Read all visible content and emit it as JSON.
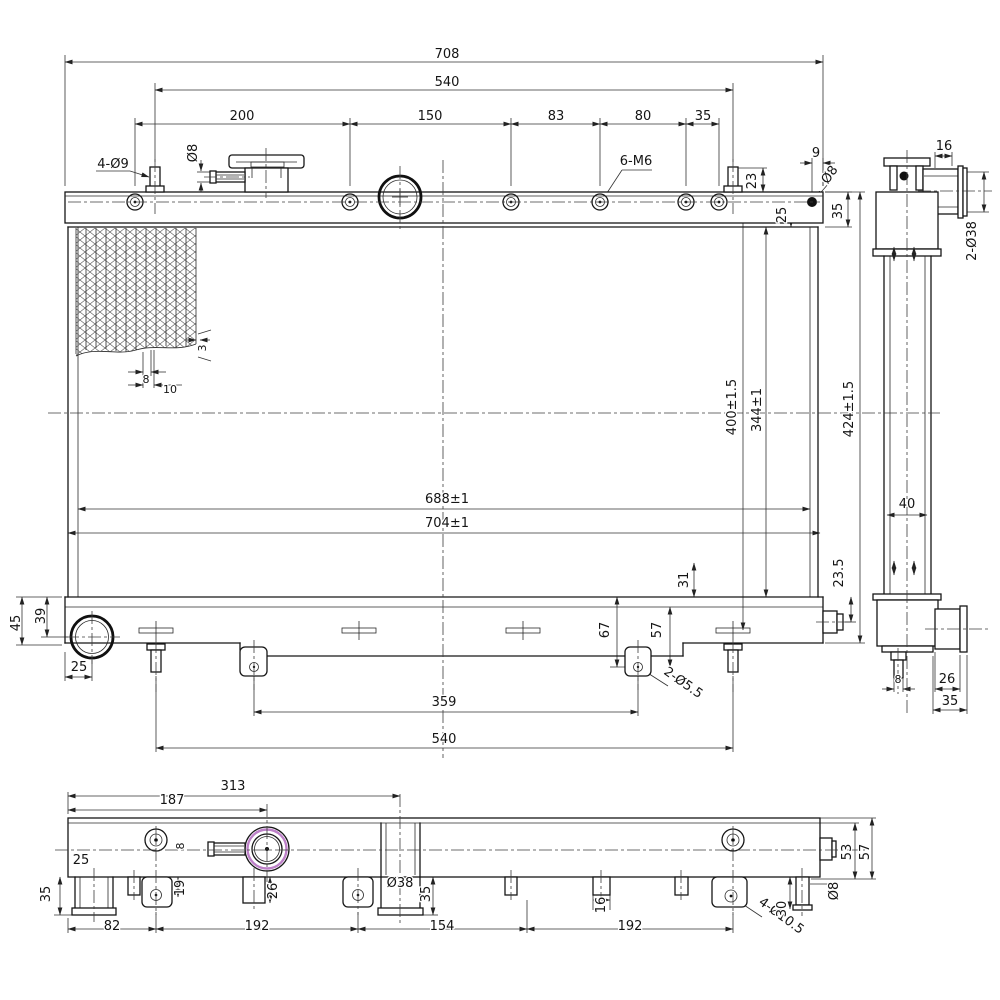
{
  "drawing": {
    "subject": "Radiator three-view dimensional engineering drawing",
    "units": "mm",
    "views": [
      "front-view",
      "side-view",
      "bottom-view"
    ],
    "line_color": "#161616",
    "accent_color": "#bd80c8",
    "notes": [
      "4-Ø9 mounting studs",
      "6-M6 threaded bosses",
      "2-Ø38 hose ports",
      "2-Ø5.5 bracket holes",
      "4-Ø10.5 bracket holes"
    ]
  },
  "labels": [
    {
      "t": "708",
      "x": 447,
      "y": 58,
      "view": "front"
    },
    {
      "t": "540",
      "x": 447,
      "y": 86,
      "view": "front"
    },
    {
      "t": "200",
      "x": 242,
      "y": 120,
      "view": "front"
    },
    {
      "t": "150",
      "x": 430,
      "y": 120,
      "view": "front"
    },
    {
      "t": "83",
      "x": 556,
      "y": 120,
      "view": "front"
    },
    {
      "t": "80",
      "x": 643,
      "y": 120,
      "view": "front"
    },
    {
      "t": "35",
      "x": 703,
      "y": 120,
      "view": "front"
    },
    {
      "t": "4-Ø9",
      "x": 113,
      "y": 168,
      "view": "front"
    },
    {
      "t": "Ø8",
      "x": 197,
      "y": 153,
      "r": -90,
      "view": "front"
    },
    {
      "t": "6-M6",
      "x": 636,
      "y": 165,
      "view": "front"
    },
    {
      "t": "23",
      "x": 756,
      "y": 181,
      "r": -90,
      "view": "front"
    },
    {
      "t": "9",
      "x": 816,
      "y": 157,
      "view": "front"
    },
    {
      "t": "Ø8",
      "x": 833,
      "y": 177,
      "r": -55,
      "view": "front"
    },
    {
      "t": "25",
      "x": 786,
      "y": 215,
      "r": -90,
      "view": "front"
    },
    {
      "t": "35",
      "x": 842,
      "y": 211,
      "r": -90,
      "view": "front"
    },
    {
      "t": "16",
      "x": 944,
      "y": 150,
      "view": "side"
    },
    {
      "t": "2-Ø38",
      "x": 976,
      "y": 241,
      "r": -90,
      "view": "side"
    },
    {
      "t": "8",
      "x": 146,
      "y": 383,
      "s": 11,
      "view": "front"
    },
    {
      "t": "10",
      "x": 170,
      "y": 393,
      "s": 11,
      "view": "front"
    },
    {
      "t": "3",
      "x": 206,
      "y": 348,
      "r": -90,
      "s": 11,
      "view": "front"
    },
    {
      "t": "688±1",
      "x": 447,
      "y": 503,
      "view": "front"
    },
    {
      "t": "704±1",
      "x": 447,
      "y": 527,
      "view": "front"
    },
    {
      "t": "400±1.5",
      "x": 736,
      "y": 407,
      "r": -90,
      "view": "front"
    },
    {
      "t": "344±1",
      "x": 761,
      "y": 410,
      "r": -90,
      "view": "front"
    },
    {
      "t": "424±1.5",
      "x": 853,
      "y": 409,
      "r": -90,
      "view": "front"
    },
    {
      "t": "40",
      "x": 907,
      "y": 508,
      "view": "side"
    },
    {
      "t": "45",
      "x": 20,
      "y": 623,
      "r": -90,
      "view": "front"
    },
    {
      "t": "39",
      "x": 45,
      "y": 616,
      "r": -90,
      "view": "front"
    },
    {
      "t": "25",
      "x": 79,
      "y": 671,
      "view": "front"
    },
    {
      "t": "31",
      "x": 688,
      "y": 580,
      "r": -90,
      "view": "front"
    },
    {
      "t": "23.5",
      "x": 843,
      "y": 573,
      "r": -90,
      "view": "front"
    },
    {
      "t": "67",
      "x": 609,
      "y": 630,
      "r": -90,
      "view": "front"
    },
    {
      "t": "57",
      "x": 661,
      "y": 630,
      "r": -90,
      "view": "front"
    },
    {
      "t": "2-Ø5.5",
      "x": 681,
      "y": 686,
      "r": 35,
      "view": "front"
    },
    {
      "t": "359",
      "x": 444,
      "y": 706,
      "view": "front"
    },
    {
      "t": "540",
      "x": 444,
      "y": 743,
      "view": "front"
    },
    {
      "t": "8",
      "x": 898,
      "y": 683,
      "s": 11,
      "view": "side"
    },
    {
      "t": "26",
      "x": 947,
      "y": 683,
      "view": "side"
    },
    {
      "t": "35",
      "x": 950,
      "y": 705,
      "view": "side"
    },
    {
      "t": "313",
      "x": 233,
      "y": 790,
      "view": "bottom"
    },
    {
      "t": "187",
      "x": 172,
      "y": 804,
      "view": "bottom"
    },
    {
      "t": "25",
      "x": 81,
      "y": 864,
      "view": "bottom"
    },
    {
      "t": "8",
      "x": 184,
      "y": 846,
      "r": -90,
      "s": 11,
      "view": "bottom"
    },
    {
      "t": "35",
      "x": 50,
      "y": 894,
      "r": -90,
      "view": "bottom"
    },
    {
      "t": "19",
      "x": 184,
      "y": 888,
      "r": -90,
      "view": "bottom"
    },
    {
      "t": "26",
      "x": 277,
      "y": 891,
      "r": -90,
      "view": "bottom"
    },
    {
      "t": "Ø38",
      "x": 400,
      "y": 887,
      "view": "bottom"
    },
    {
      "t": "35",
      "x": 430,
      "y": 894,
      "r": -90,
      "view": "bottom"
    },
    {
      "t": "16",
      "x": 605,
      "y": 905,
      "r": -90,
      "view": "bottom"
    },
    {
      "t": "82",
      "x": 112,
      "y": 930,
      "view": "bottom"
    },
    {
      "t": "192",
      "x": 257,
      "y": 930,
      "view": "bottom"
    },
    {
      "t": "154",
      "x": 442,
      "y": 930,
      "view": "bottom"
    },
    {
      "t": "192",
      "x": 630,
      "y": 930,
      "view": "bottom"
    },
    {
      "t": "4-Ø10.5",
      "x": 779,
      "y": 919,
      "r": 36,
      "view": "bottom"
    },
    {
      "t": "30",
      "x": 786,
      "y": 909,
      "r": -90,
      "view": "bottom"
    },
    {
      "t": "Ø8",
      "x": 838,
      "y": 891,
      "r": -90,
      "view": "bottom"
    },
    {
      "t": "53",
      "x": 851,
      "y": 852,
      "r": -90,
      "view": "bottom"
    },
    {
      "t": "57",
      "x": 869,
      "y": 852,
      "r": -90,
      "view": "bottom"
    }
  ]
}
